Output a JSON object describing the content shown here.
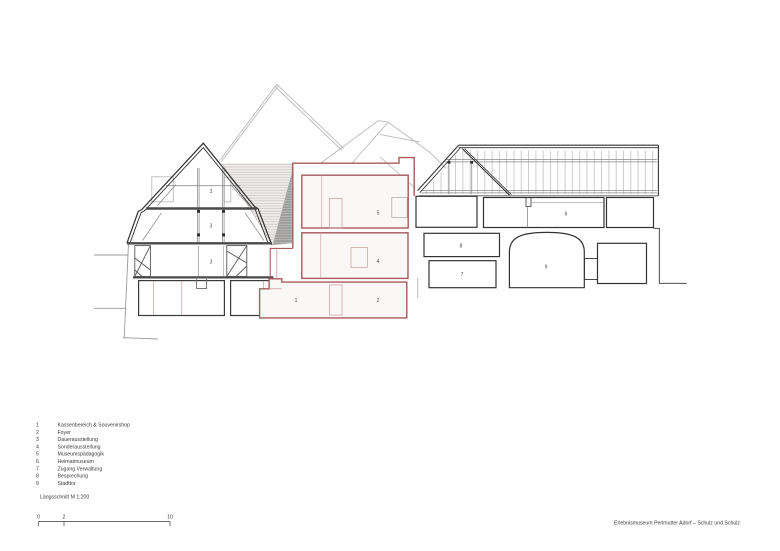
{
  "drawing": {
    "caption": "Längsschnitt M 1:200",
    "project_title": "Erlebnismuseum Perlmutter Adorf – Schulz und Schulz"
  },
  "colors": {
    "cut_line": "#333333",
    "new_construction_red": "#a85a5c",
    "background_grey": "#b9b9b9"
  },
  "legend": {
    "items": [
      {
        "number": "1",
        "label": "Kassenbereich & Souvenirshop"
      },
      {
        "number": "2",
        "label": "Foyer"
      },
      {
        "number": "3",
        "label": "Dauerausstellung"
      },
      {
        "number": "4",
        "label": "Sonderausstellung"
      },
      {
        "number": "5",
        "label": "Museumspädagogik"
      },
      {
        "number": "6",
        "label": "Heimatmuseum"
      },
      {
        "number": "7",
        "label": "Zugang Verwaltung"
      },
      {
        "number": "8",
        "label": "Besprechung"
      },
      {
        "number": "9",
        "label": "Stadttor"
      }
    ]
  },
  "scale_bar": {
    "tick_labels": [
      "0",
      "2",
      "10"
    ]
  },
  "room_markers": [
    "3",
    "3",
    "3",
    "1",
    "2",
    "4",
    "5",
    "6",
    "7",
    "8",
    "9"
  ]
}
